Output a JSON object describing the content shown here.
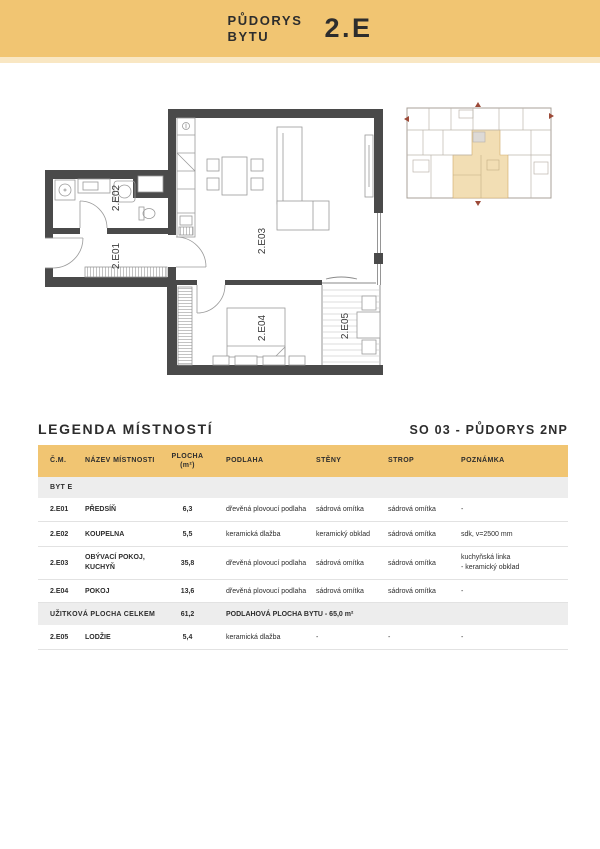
{
  "header": {
    "title_line1": "PŮDORYS",
    "title_line2": "BYTU",
    "unit": "2.E"
  },
  "legend": {
    "title": "LEGENDA MÍSTNOSTÍ",
    "drawing_ref": "SO 03 - PŮDORYS 2NP"
  },
  "plan": {
    "labels": {
      "e01": "2.E01",
      "e02": "2.E02",
      "e03": "2.E03",
      "e04": "2.E04",
      "e05": "2.E05"
    }
  },
  "colors": {
    "band": "#F1C572",
    "band_light": "#F9E7C3",
    "wall": "#4A4A4A",
    "overview_highlight": "#F2DEB4",
    "row_gray": "#EDEDED",
    "text": "#2D2D2D",
    "marker_red": "#9C4A38"
  },
  "table": {
    "headers": {
      "cm": "Č.M.",
      "nazev": "NÁZEV MÍSTNOSTI",
      "plocha_line1": "PLOCHA",
      "plocha_line2": "(m²)",
      "podlaha": "PODLAHA",
      "steny": "STĚNY",
      "strop": "STROP",
      "poznamka": "POZNÁMKA"
    },
    "section_label": "BYT E",
    "rows": [
      {
        "cm": "2.E01",
        "nazev": "PŘEDSÍŇ",
        "plocha": "6,3",
        "podlaha": "dřevěná plovoucí podlaha",
        "steny": "sádrová omítka",
        "strop": "sádrová omítka",
        "poznamka": "-"
      },
      {
        "cm": "2.E02",
        "nazev": "KOUPELNA",
        "plocha": "5,5",
        "podlaha": "keramická dlažba",
        "steny": "keramický obklad",
        "strop": "sádrová omítka",
        "poznamka": "sdk, v=2500 mm"
      },
      {
        "cm": "2.E03",
        "nazev": "OBÝVACÍ POKOJ,\nKUCHYŇ",
        "plocha": "35,8",
        "podlaha": "dřevěná plovoucí podlaha",
        "steny": "sádrová omítka",
        "strop": "sádrová omítka",
        "poznamka": "kuchyňská linka\n- keramický obklad"
      },
      {
        "cm": "2.E04",
        "nazev": "POKOJ",
        "plocha": "13,6",
        "podlaha": "dřevěná plovoucí podlaha",
        "steny": "sádrová omítka",
        "strop": "sádrová omítka",
        "poznamka": "-"
      }
    ],
    "total": {
      "label": "UŽITKOVÁ PLOCHA CELKEM",
      "plocha": "61,2",
      "note": "PODLAHOVÁ PLOCHA BYTU - 65,0 m²"
    },
    "rows_after": [
      {
        "cm": "2.E05",
        "nazev": "LODŽIE",
        "plocha": "5,4",
        "podlaha": "keramická dlažba",
        "steny": "-",
        "strop": "-",
        "poznamka": "-"
      }
    ]
  }
}
